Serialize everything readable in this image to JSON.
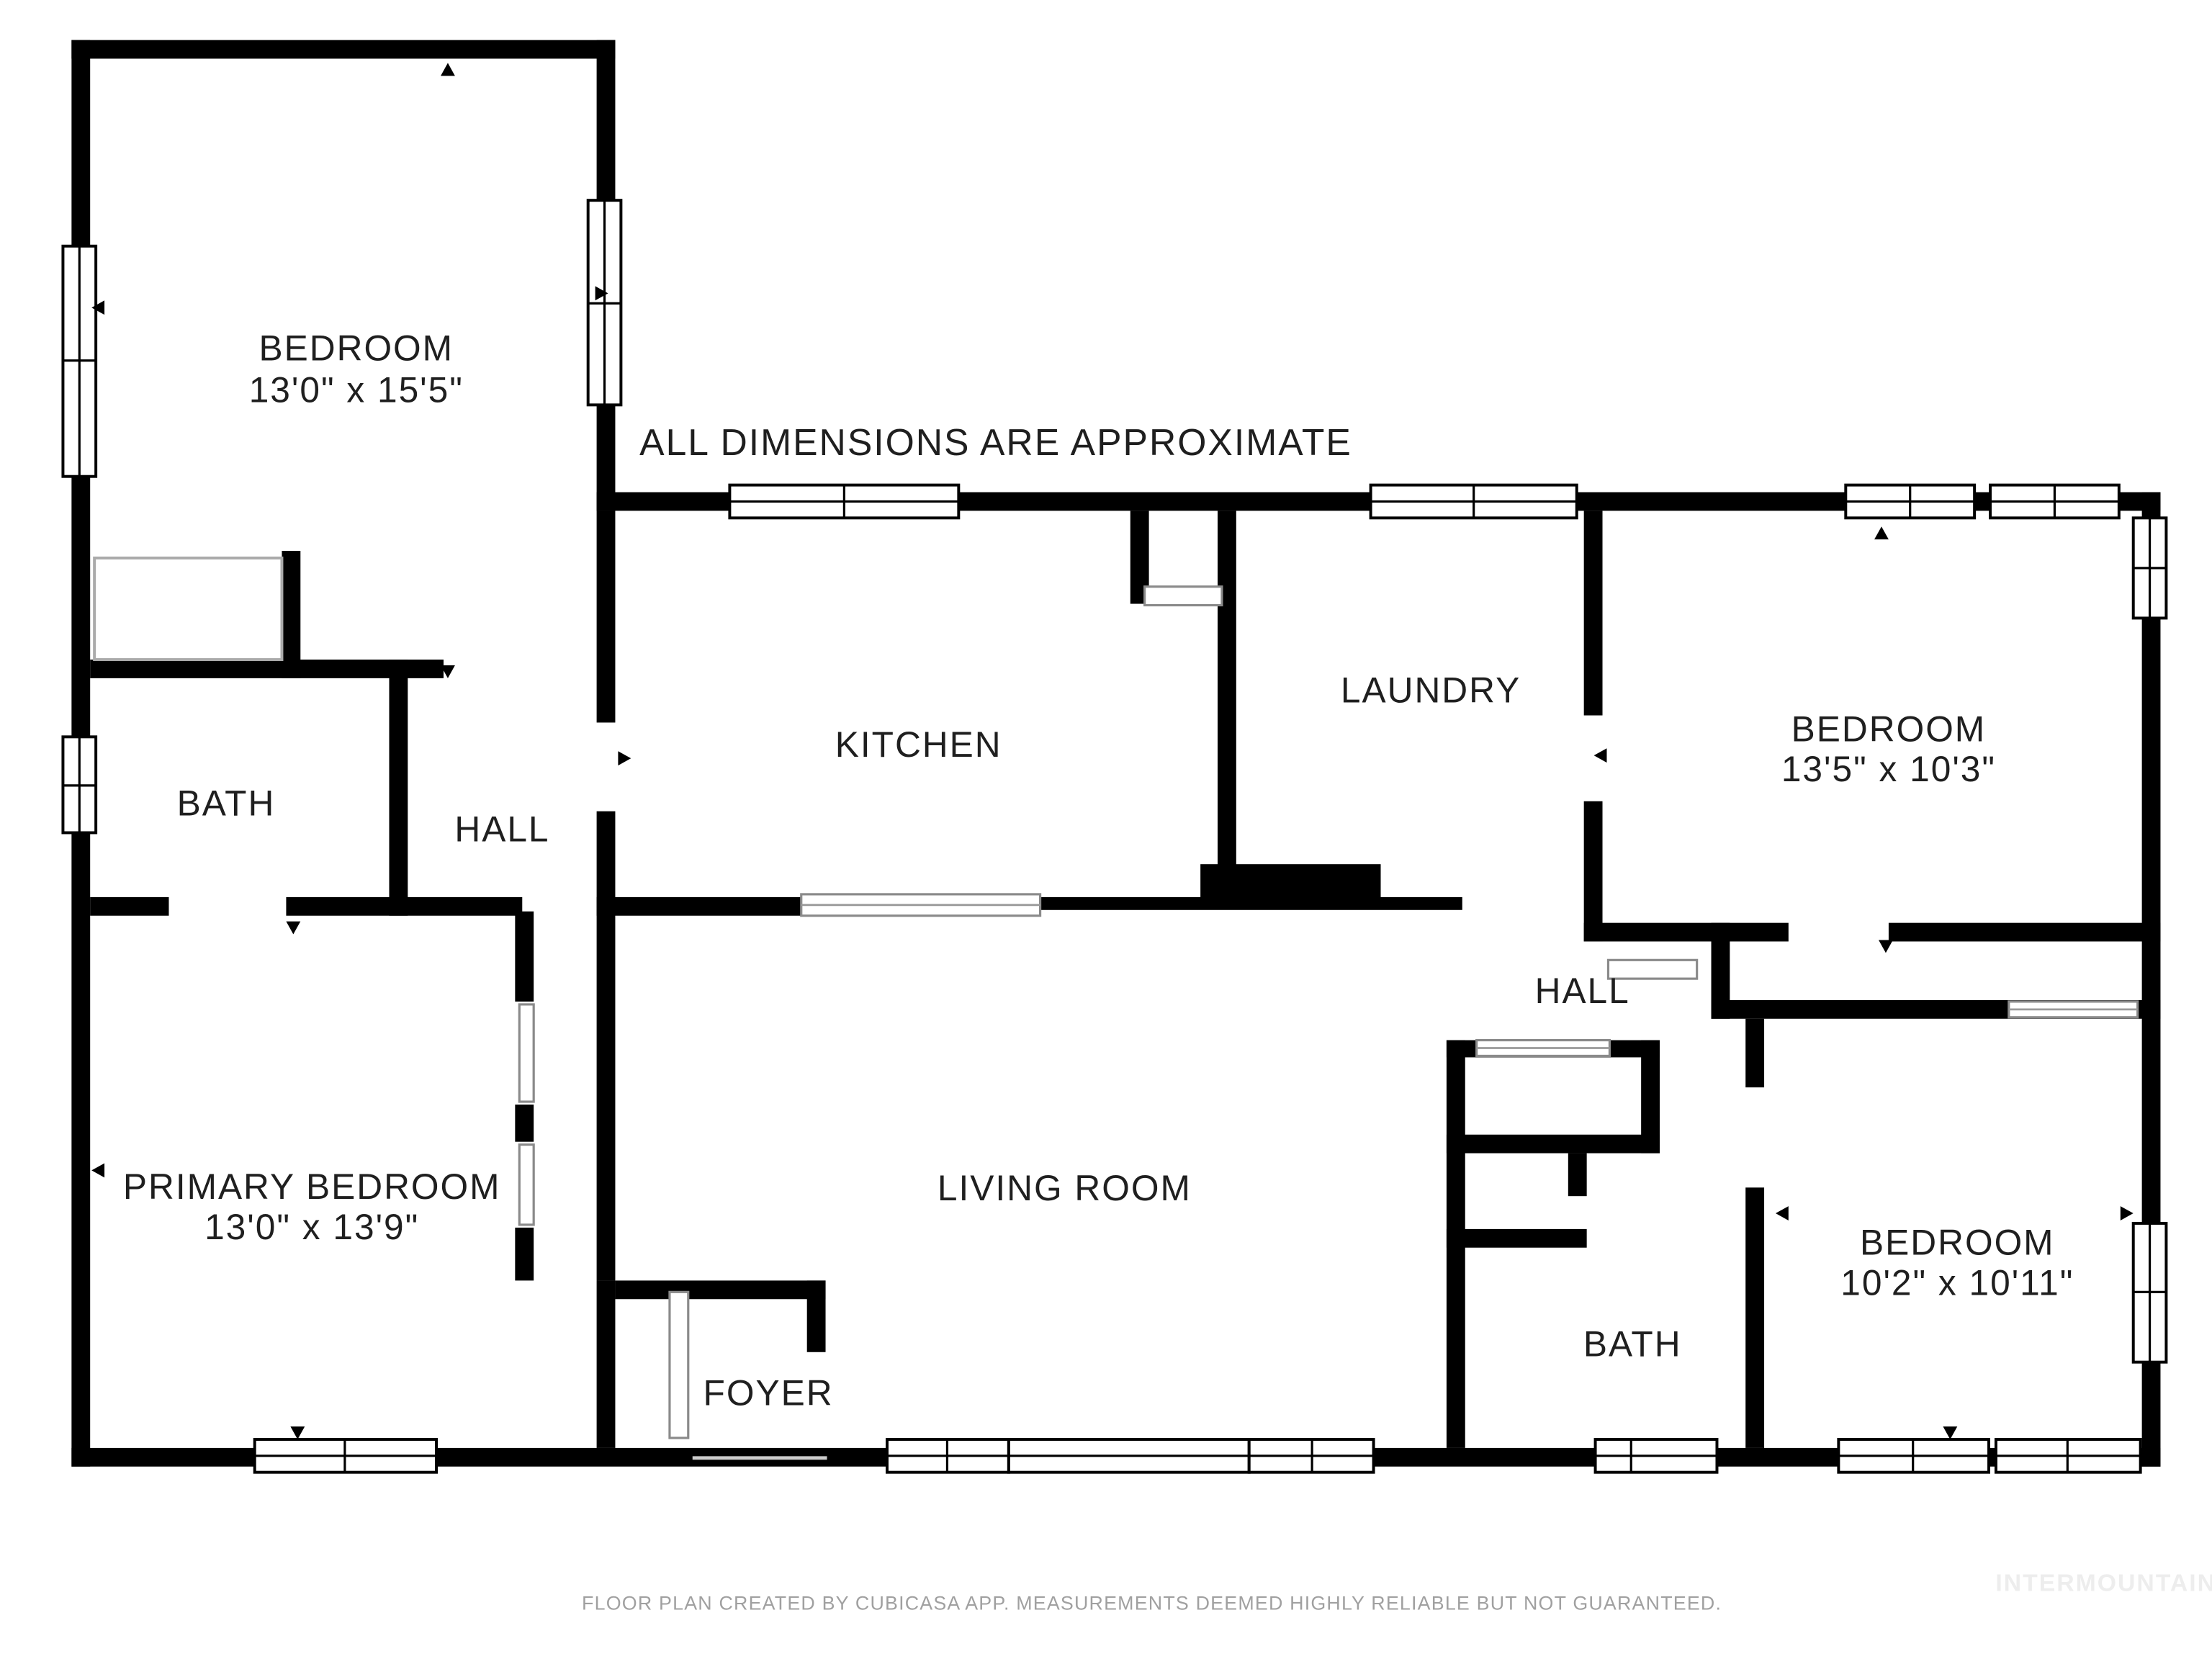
{
  "note": "ALL DIMENSIONS ARE APPROXIMATE",
  "rooms": {
    "bedroom_tl": {
      "name": "BEDROOM",
      "dims": "13'0\" x 15'5\""
    },
    "kitchen": {
      "name": "KITCHEN"
    },
    "laundry": {
      "name": "LAUNDRY"
    },
    "bedroom_r": {
      "name": "BEDROOM",
      "dims": "13'5\" x 10'3\""
    },
    "bath_tl": {
      "name": "BATH"
    },
    "hall_tl": {
      "name": "HALL"
    },
    "primary_bedroom": {
      "name": "PRIMARY BEDROOM",
      "dims": "13'0\" x 13'9\""
    },
    "living_room": {
      "name": "LIVING ROOM"
    },
    "hall_r": {
      "name": "HALL"
    },
    "bath_r": {
      "name": "BATH"
    },
    "bedroom_br": {
      "name": "BEDROOM",
      "dims": "10'2\" x 10'11\""
    },
    "foyer": {
      "name": "FOYER"
    }
  },
  "footer": {
    "disclaimer": "FLOOR PLAN CREATED BY CUBICASA APP. MEASUREMENTS DEEMED HIGHLY RELIABLE BUT NOT GUARANTEED.",
    "watermark": "INTERMOUNTAIN"
  },
  "colors": {
    "wall": "#000000",
    "label": "#1f1f1f",
    "disclaimer": "#a0a0a0",
    "watermark": "#ededed",
    "background": "#ffffff"
  }
}
